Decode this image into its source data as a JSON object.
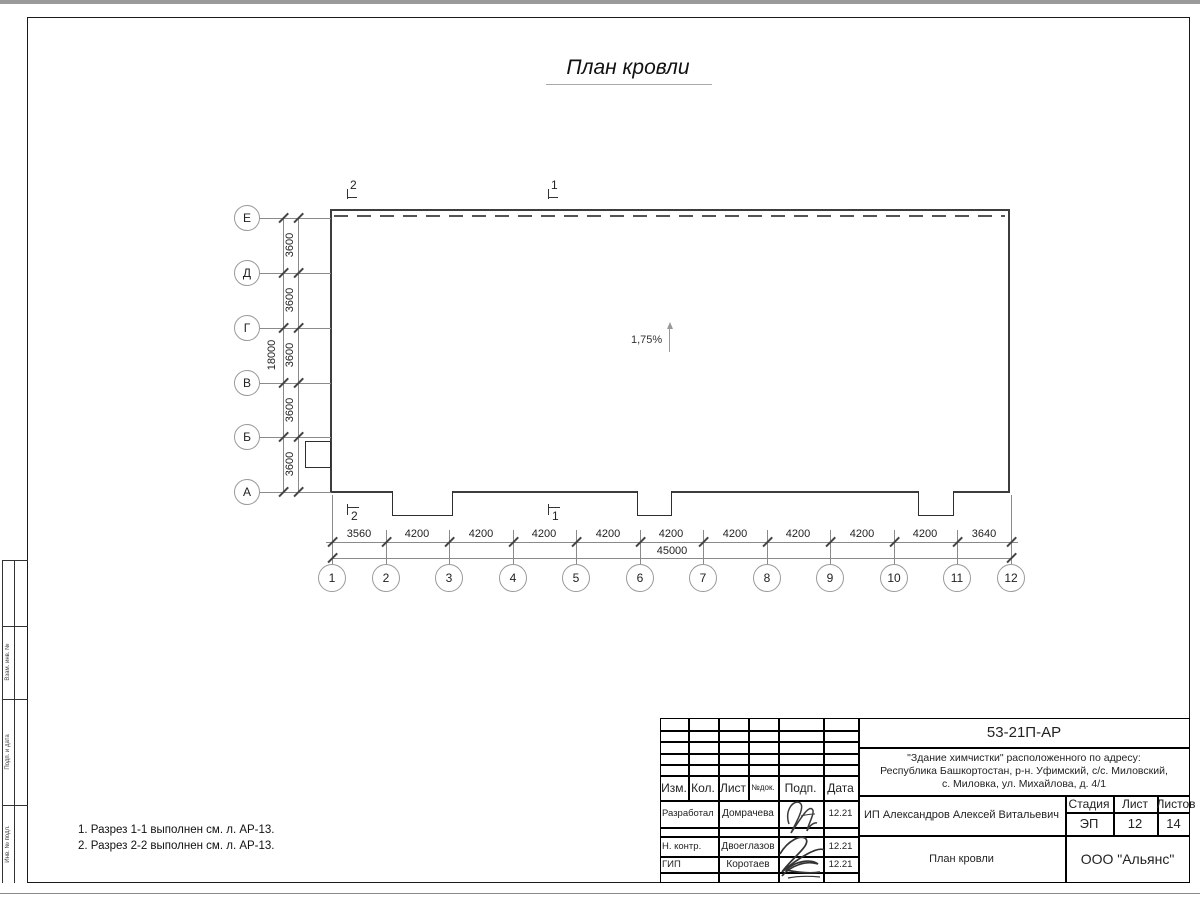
{
  "title": "План кровли",
  "slope": {
    "label": "1,75%"
  },
  "axes": {
    "rows": [
      "Е",
      "Д",
      "Г",
      "В",
      "Б",
      "А"
    ],
    "cols": [
      "1",
      "2",
      "3",
      "4",
      "5",
      "6",
      "7",
      "8",
      "9",
      "10",
      "11",
      "12"
    ]
  },
  "dimensions": {
    "row_segments": [
      "3600",
      "3600",
      "3600",
      "3600",
      "3600"
    ],
    "row_total": "18000",
    "col_segments": [
      "3560",
      "4200",
      "4200",
      "4200",
      "4200",
      "4200",
      "4200",
      "4200",
      "4200",
      "4200",
      "3640"
    ],
    "col_total": "45000"
  },
  "sections": {
    "top": [
      "2",
      "1"
    ],
    "bottom": [
      "2",
      "1"
    ]
  },
  "notes": [
    "1. Разрез 1-1 выполнен см. л. АР-13.",
    "2. Разрез 2-2 выполнен см. л. АР-13."
  ],
  "side_strip": {
    "labels": [
      "Взам. инв. №",
      "Подп. и дата",
      "Инв. № подл."
    ]
  },
  "title_block": {
    "doc_number": "53-21П-АР",
    "address_lines": [
      "\"Здание химчистки\" расположенного по адресу:",
      "Республика Башкортостан, р-н. Уфимский, с/с. Миловский,",
      "с. Миловка, ул. Михайлова, д. 4/1"
    ],
    "header_cols": {
      "izm": "Изм.",
      "kol": "Кол.",
      "list": "Лист",
      "ndok": "№док.",
      "podp": "Подп.",
      "data": "Дата"
    },
    "rows": [
      {
        "role": "Разработал",
        "name": "Домрачева",
        "date": "12.21"
      },
      {
        "role": "Н. контр.",
        "name": "Двоеглазов",
        "date": "12.21"
      },
      {
        "role": "ГИП",
        "name": "Коротаев",
        "date": "12.21"
      }
    ],
    "client": "ИП Александров Алексей Витальевич",
    "stage_header": {
      "stage": "Стадия",
      "sheet": "Лист",
      "sheets": "Листов"
    },
    "stage_values": {
      "stage": "ЭП",
      "sheet": "12",
      "sheets": "14"
    },
    "drawing_name": "План кровли",
    "company": "ООО \"Альянс\""
  }
}
